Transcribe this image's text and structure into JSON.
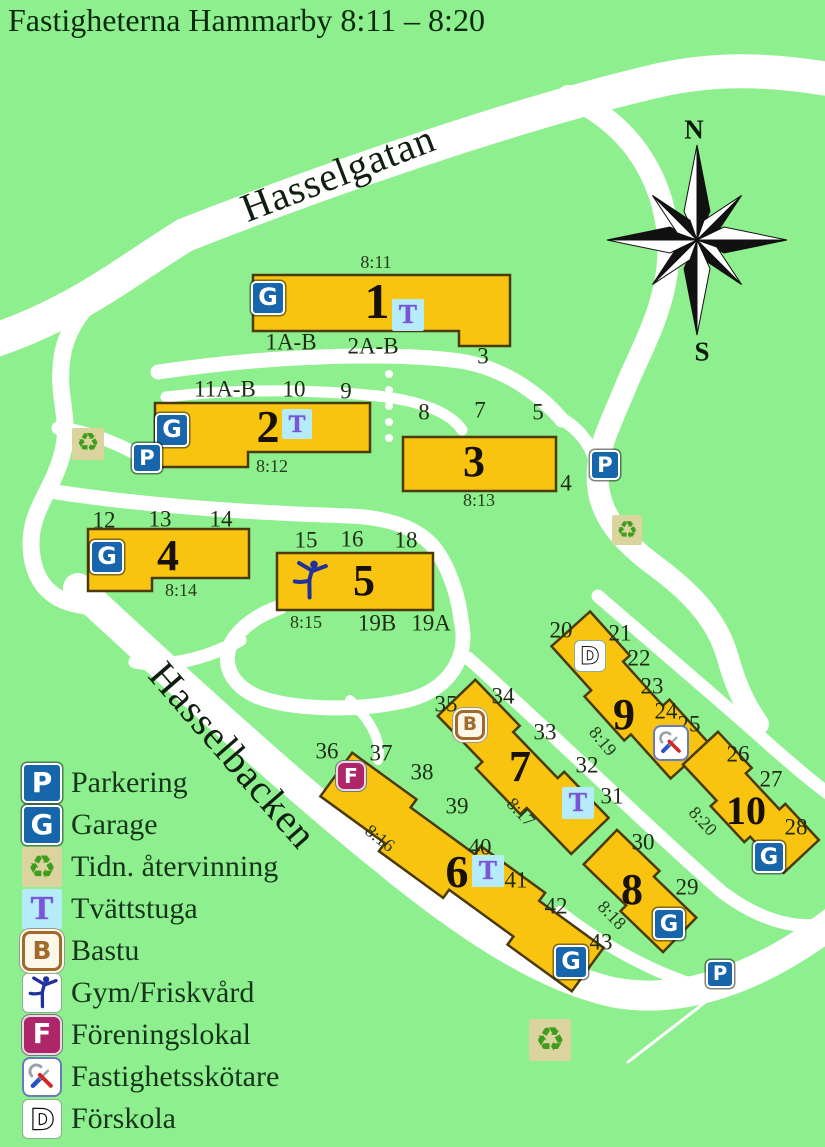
{
  "title": "Fastigheterna Hammarby 8:11 – 8:20",
  "compass": {
    "north": "N",
    "south": "S"
  },
  "streets": [
    {
      "name": "Hasselgatan"
    },
    {
      "name": "Hasselbacken"
    }
  ],
  "colors": {
    "background": "#8def8e",
    "road": "#ffffff",
    "building_fill": "#f9c40f",
    "building_border": "#4a3a06",
    "icon_blue": "#1765ab",
    "laundry_bg": "#b6ecfa",
    "laundry_letter": "#7b55d6",
    "recycle_green": "#3f9d1e",
    "sauna_brown": "#a06a2c",
    "club_magenta": "#ae2569",
    "gym_blue": "#21339b",
    "tool_blue": "#2a52c8",
    "tool_red": "#d42525"
  },
  "buildings": [
    {
      "number": "1",
      "property": "8:11",
      "shape": [
        [
          253,
          275
        ],
        [
          510,
          275
        ],
        [
          510,
          346
        ],
        [
          459,
          346
        ],
        [
          459,
          331
        ],
        [
          253,
          331
        ]
      ],
      "number_pos": {
        "x": 377,
        "y": 301,
        "size": 50
      },
      "property_pos": {
        "x": 376,
        "y": 262,
        "rot": 0
      },
      "entrances": [
        {
          "label": "1A-B",
          "x": 291,
          "y": 342
        },
        {
          "label": "2A-B",
          "x": 373,
          "y": 346
        },
        {
          "label": "3",
          "x": 483,
          "y": 356
        }
      ],
      "icons": [
        {
          "type": "garage",
          "x": 268,
          "y": 298,
          "s": 34
        },
        {
          "type": "laundry",
          "x": 408,
          "y": 315,
          "s": 32
        }
      ]
    },
    {
      "number": "2",
      "property": "8:12",
      "shape": [
        [
          155,
          403
        ],
        [
          370,
          403
        ],
        [
          370,
          452
        ],
        [
          248,
          452
        ],
        [
          248,
          467
        ],
        [
          155,
          467
        ]
      ],
      "number_pos": {
        "x": 268,
        "y": 427,
        "size": 46
      },
      "property_pos": {
        "x": 272,
        "y": 466,
        "rot": 0
      },
      "entrances": [
        {
          "label": "11A-B",
          "x": 225,
          "y": 389
        },
        {
          "label": "10",
          "x": 294,
          "y": 389
        },
        {
          "label": "9",
          "x": 346,
          "y": 391
        }
      ],
      "icons": [
        {
          "type": "garage",
          "x": 172,
          "y": 430,
          "s": 34
        },
        {
          "type": "laundry",
          "x": 297,
          "y": 424,
          "s": 30
        }
      ]
    },
    {
      "number": "3",
      "property": "8:13",
      "shape": [
        [
          403,
          437
        ],
        [
          556,
          437
        ],
        [
          556,
          491
        ],
        [
          403,
          491
        ]
      ],
      "number_pos": {
        "x": 474,
        "y": 462,
        "size": 44
      },
      "property_pos": {
        "x": 479,
        "y": 500,
        "rot": 0
      },
      "entrances": [
        {
          "label": "8",
          "x": 424,
          "y": 412
        },
        {
          "label": "7",
          "x": 480,
          "y": 410
        },
        {
          "label": "5",
          "x": 538,
          "y": 412
        },
        {
          "label": "4",
          "x": 566,
          "y": 483
        }
      ],
      "icons": []
    },
    {
      "number": "4",
      "property": "8:14",
      "shape": [
        [
          88,
          529
        ],
        [
          249,
          529
        ],
        [
          249,
          578
        ],
        [
          152,
          578
        ],
        [
          152,
          591
        ],
        [
          88,
          591
        ]
      ],
      "number_pos": {
        "x": 168,
        "y": 556,
        "size": 44
      },
      "property_pos": {
        "x": 181,
        "y": 590,
        "rot": 0
      },
      "entrances": [
        {
          "label": "12",
          "x": 104,
          "y": 520
        },
        {
          "label": "13",
          "x": 160,
          "y": 519
        },
        {
          "label": "14",
          "x": 221,
          "y": 519
        }
      ],
      "icons": [
        {
          "type": "garage",
          "x": 107,
          "y": 557,
          "s": 34
        }
      ]
    },
    {
      "number": "5",
      "property": "8:15",
      "shape": [
        [
          277,
          553
        ],
        [
          433,
          553
        ],
        [
          433,
          610
        ],
        [
          277,
          610
        ]
      ],
      "number_pos": {
        "x": 364,
        "y": 581,
        "size": 44
      },
      "property_pos": {
        "x": 306,
        "y": 622,
        "rot": 0
      },
      "entrances": [
        {
          "label": "15",
          "x": 306,
          "y": 540
        },
        {
          "label": "16",
          "x": 352,
          "y": 539
        },
        {
          "label": "18",
          "x": 406,
          "y": 540
        },
        {
          "label": "19B",
          "x": 377,
          "y": 623
        },
        {
          "label": "19A",
          "x": 431,
          "y": 623
        }
      ],
      "icons": [
        {
          "type": "gym",
          "x": 309,
          "y": 581,
          "s": 46
        }
      ]
    },
    {
      "number": "6",
      "property": "8:16",
      "rrect": {
        "cx": 462,
        "cy": 872,
        "len": 318,
        "wid": 54,
        "rot": 36,
        "steps": 4,
        "off": 10
      },
      "number_pos": {
        "x": 457,
        "y": 872,
        "size": 46
      },
      "property_pos": {
        "x": 380,
        "y": 838,
        "rot": 38
      },
      "entrances": [
        {
          "label": "36",
          "x": 327,
          "y": 751
        },
        {
          "label": "37",
          "x": 381,
          "y": 753
        },
        {
          "label": "38",
          "x": 422,
          "y": 772
        },
        {
          "label": "39",
          "x": 457,
          "y": 806
        },
        {
          "label": "40",
          "x": 480,
          "y": 847
        },
        {
          "label": "41",
          "x": 516,
          "y": 880
        },
        {
          "label": "42",
          "x": 556,
          "y": 906
        },
        {
          "label": "43",
          "x": 601,
          "y": 942
        }
      ],
      "icons": [
        {
          "type": "clubroom",
          "x": 351,
          "y": 776,
          "s": 30
        },
        {
          "type": "laundry",
          "x": 488,
          "y": 871,
          "s": 32
        },
        {
          "type": "garage",
          "x": 571,
          "y": 962,
          "s": 34
        }
      ]
    },
    {
      "number": "7",
      "property": "8:17",
      "rrect": {
        "cx": 520,
        "cy": 770,
        "len": 192,
        "wid": 52,
        "rot": 46,
        "steps": 3,
        "off": 9
      },
      "number_pos": {
        "x": 520,
        "y": 767,
        "size": 44
      },
      "property_pos": {
        "x": 521,
        "y": 812,
        "rot": 46
      },
      "entrances": [
        {
          "label": "35",
          "x": 446,
          "y": 704
        },
        {
          "label": "34",
          "x": 503,
          "y": 696
        },
        {
          "label": "33",
          "x": 545,
          "y": 732
        },
        {
          "label": "32",
          "x": 587,
          "y": 765
        },
        {
          "label": "31",
          "x": 612,
          "y": 796
        }
      ],
      "icons": [
        {
          "type": "sauna",
          "x": 470,
          "y": 725,
          "s": 30
        },
        {
          "type": "laundry",
          "x": 578,
          "y": 803,
          "s": 32
        }
      ]
    },
    {
      "number": "8",
      "property": "8:18",
      "rrect": {
        "cx": 640,
        "cy": 891,
        "len": 118,
        "wid": 48,
        "rot": 44,
        "steps": 2,
        "off": 8
      },
      "number_pos": {
        "x": 632,
        "y": 890,
        "size": 44
      },
      "property_pos": {
        "x": 612,
        "y": 915,
        "rot": 46
      },
      "entrances": [
        {
          "label": "30",
          "x": 643,
          "y": 842
        },
        {
          "label": "29",
          "x": 687,
          "y": 887
        }
      ],
      "icons": [
        {
          "type": "garage",
          "x": 669,
          "y": 924,
          "s": 32
        }
      ]
    },
    {
      "number": "9",
      "property": "8:19",
      "rrect": {
        "cx": 627,
        "cy": 698,
        "len": 178,
        "wid": 52,
        "rot": 48,
        "steps": 3,
        "off": 9
      },
      "number_pos": {
        "x": 624,
        "y": 715,
        "size": 44
      },
      "property_pos": {
        "x": 603,
        "y": 741,
        "rot": 50
      },
      "entrances": [
        {
          "label": "20",
          "x": 561,
          "y": 630
        },
        {
          "label": "21",
          "x": 620,
          "y": 633
        },
        {
          "label": "22",
          "x": 639,
          "y": 658
        },
        {
          "label": "23",
          "x": 652,
          "y": 686
        },
        {
          "label": "24",
          "x": 666,
          "y": 711
        },
        {
          "label": "25",
          "x": 689,
          "y": 724
        }
      ],
      "icons": [
        {
          "type": "preschool",
          "x": 590,
          "y": 656,
          "s": 32
        },
        {
          "type": "caretaker",
          "x": 671,
          "y": 743,
          "s": 36
        }
      ]
    },
    {
      "number": "10",
      "property": "8:20",
      "rrect": {
        "cx": 748,
        "cy": 805,
        "len": 148,
        "wid": 48,
        "rot": 47,
        "steps": 3,
        "off": 8
      },
      "number_pos": {
        "x": 746,
        "y": 811,
        "size": 40
      },
      "property_pos": {
        "x": 703,
        "y": 821,
        "rot": 47
      },
      "entrances": [
        {
          "label": "26",
          "x": 738,
          "y": 754
        },
        {
          "label": "27",
          "x": 771,
          "y": 779
        },
        {
          "label": "28",
          "x": 796,
          "y": 827
        }
      ],
      "icons": [
        {
          "type": "garage",
          "x": 769,
          "y": 857,
          "s": 32
        }
      ]
    }
  ],
  "site_icons": [
    {
      "type": "recycling",
      "x": 88,
      "y": 444,
      "s": 32
    },
    {
      "type": "parking",
      "x": 147,
      "y": 458,
      "s": 30
    },
    {
      "type": "parking",
      "x": 605,
      "y": 465,
      "s": 30
    },
    {
      "type": "recycling",
      "x": 627,
      "y": 530,
      "s": 30
    },
    {
      "type": "parking",
      "x": 720,
      "y": 974,
      "s": 28
    },
    {
      "type": "recycling",
      "x": 550,
      "y": 1040,
      "s": 42
    }
  ],
  "legend": {
    "items": [
      {
        "icon": "parking",
        "label": "Parkering"
      },
      {
        "icon": "garage",
        "label": "Garage"
      },
      {
        "icon": "recycling",
        "label": "Tidn. återvinning"
      },
      {
        "icon": "laundry",
        "label": "Tvättstuga"
      },
      {
        "icon": "sauna",
        "label": "Bastu"
      },
      {
        "icon": "gym",
        "label": "Gym/Friskvård"
      },
      {
        "icon": "clubroom",
        "label": "Föreningslokal"
      },
      {
        "icon": "caretaker",
        "label": "Fastighetsskötare"
      },
      {
        "icon": "preschool",
        "label": "Förskola"
      }
    ]
  }
}
